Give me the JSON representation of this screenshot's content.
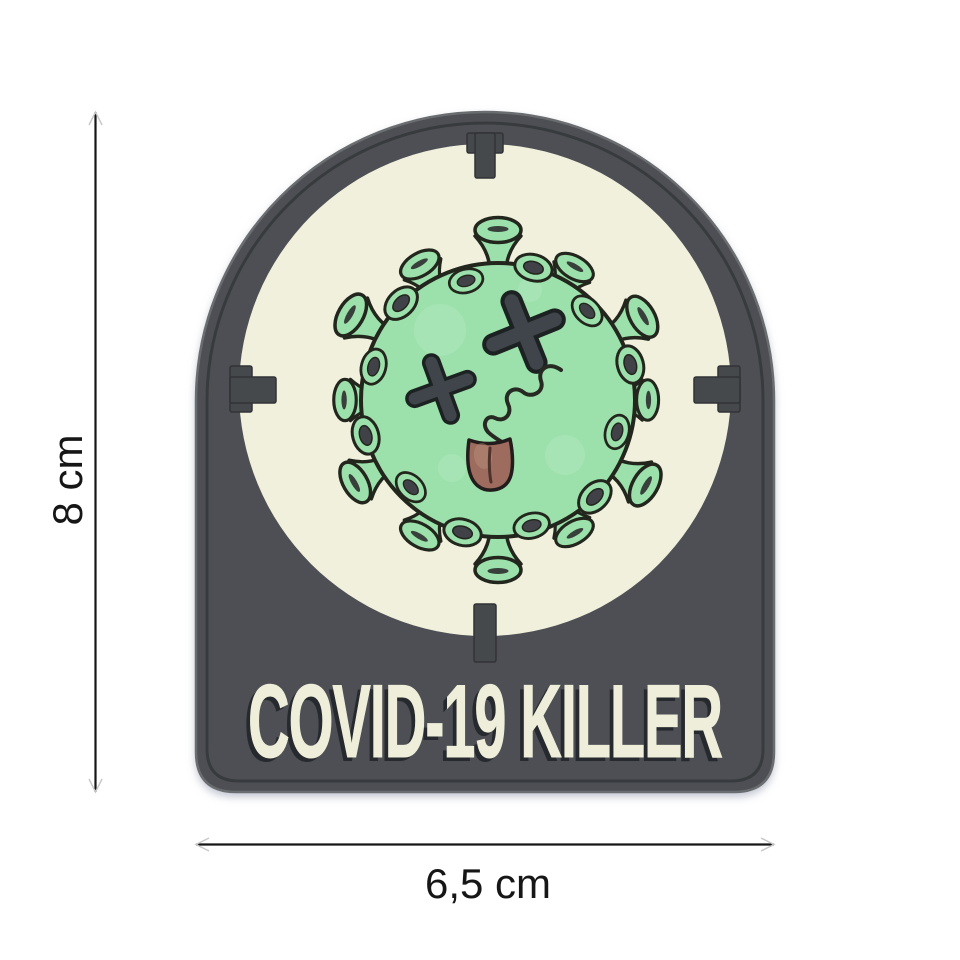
{
  "scene": {
    "type": "product-photo",
    "background_color": "#ffffff",
    "patch": {
      "text": "COVID-19 KILLER",
      "colors": {
        "base_gray": "#4e5054",
        "edge_highlight": "#6b6d70",
        "groove": "#36383c",
        "reticle_tick": "#45484c",
        "glow_panel": "#f0f0dc",
        "virus_green": "#9ce0ab",
        "virus_outline": "#22271f",
        "eye_gray": "#40454b",
        "cup_center": "#3f4347",
        "tongue": "#9d6c5f",
        "text_cream": "#efeeda",
        "text_shadow": "#26292d"
      }
    },
    "dimensions": {
      "height_label": "8 cm",
      "width_label": "6,5 cm",
      "line_color": "#161616"
    }
  }
}
